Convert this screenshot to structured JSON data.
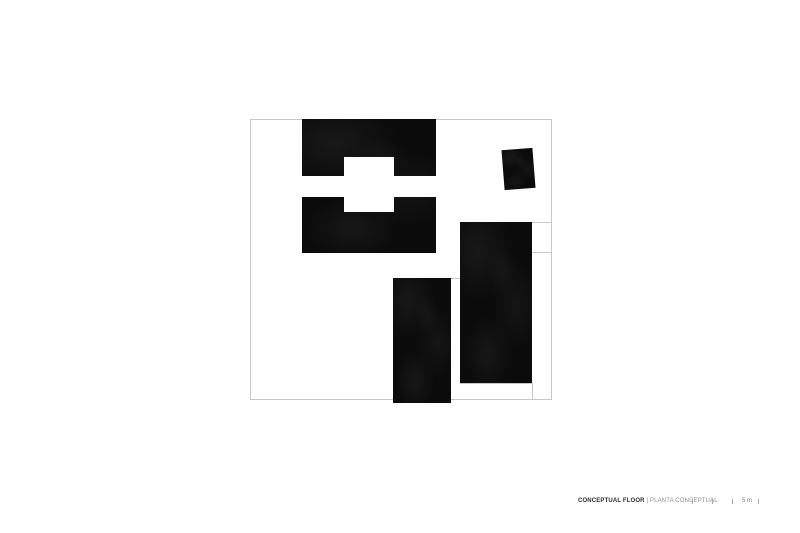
{
  "footer": {
    "title_primary": "CONCEPTUAL FLOOR",
    "separator": "|",
    "title_secondary": "PLANTA CONCEPTUAL",
    "scale_label": "5 m",
    "title_primary_color": "#2e2e2e",
    "title_secondary_color": "#8f8f8f",
    "scale_label_color": "#7a7a7a",
    "tick_color": "#a8a8a8"
  },
  "plan": {
    "ink_color": "#0b0b0b",
    "line_color": "#c6c6c6",
    "outline": {
      "x": 250,
      "y": 119,
      "w": 302,
      "h": 281
    },
    "solids": [
      {
        "name": "upper-left-block",
        "x": 302,
        "y": 119,
        "w": 134,
        "h": 134,
        "rotate": 0
      },
      {
        "name": "small-rotated-block",
        "x": 503,
        "y": 148.5,
        "w": 31,
        "h": 40,
        "rotate": -4.5
      },
      {
        "name": "tall-right-block",
        "x": 459.5,
        "y": 221.5,
        "w": 72,
        "h": 161,
        "rotate": 0
      },
      {
        "name": "lower-middle-block",
        "x": 393,
        "y": 278,
        "w": 58,
        "h": 125,
        "rotate": 0
      }
    ],
    "voids": [
      {
        "name": "cross-band-void",
        "x": 302,
        "y": 175.5,
        "w": 134,
        "h": 21
      },
      {
        "name": "cross-square-void",
        "x": 344,
        "y": 156.5,
        "w": 50,
        "h": 55.5
      }
    ],
    "lines": [
      {
        "name": "right-bay-line-upper",
        "x1": 531.5,
        "y1": 222,
        "x2": 552,
        "y2": 222
      },
      {
        "name": "right-bay-line-lower",
        "x1": 531.5,
        "y1": 251.5,
        "x2": 552,
        "y2": 251.5
      },
      {
        "name": "middle-connector-line",
        "x1": 451,
        "y1": 277.5,
        "x2": 459.5,
        "y2": 277.5
      },
      {
        "name": "tall-block-base-line",
        "x1": 459.5,
        "y1": 383,
        "x2": 532,
        "y2": 383
      },
      {
        "name": "right-edge-drop-line",
        "x1": 531.5,
        "y1": 383,
        "x2": 531.5,
        "y2": 400
      }
    ],
    "scale_ticks_x": [
      692,
      712,
      732,
      758
    ]
  }
}
